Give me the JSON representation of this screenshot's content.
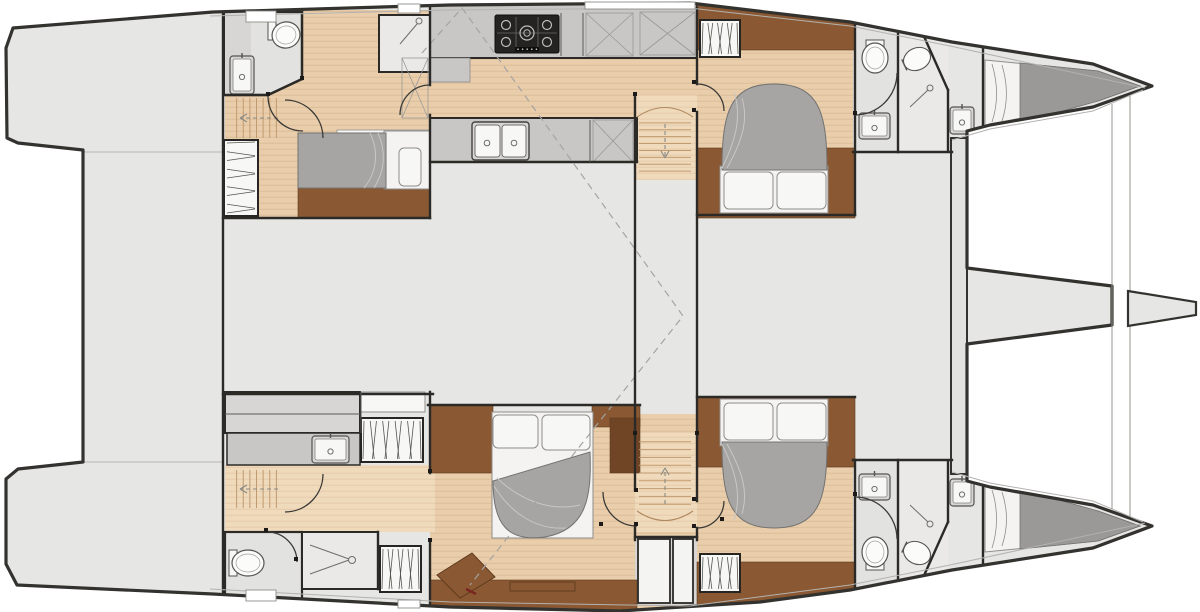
{
  "plan_name": "catamaran-interior-deck-plan",
  "canvas": {
    "width": 1200,
    "height": 612
  },
  "palette": {
    "deck": "#e6e6e4",
    "room": "#e2e2e0",
    "room_light": "#eae9e7",
    "white_box": "#f7f7f5",
    "counter": "#c8c7c5",
    "cabinet": "#d7d6d4",
    "wood": "#eaceac",
    "wood_light": "#f0dabc",
    "wood_stripe": "#d8ba96",
    "wood_stripe_light": "#e2c9a8",
    "tread": "#c19a6f",
    "walnut": "#8a5933",
    "walnut_dark": "#6f4526",
    "walnut_edge": "#5e3a1d",
    "duvet": "#a6a5a3",
    "duvet_edge": "#737270",
    "mattress_gray": "#9a9998",
    "sheet": "#f4f3f1",
    "outline": "#33322e",
    "wall": "#2b2a27",
    "thin": "#8b8a87",
    "inset": "#b3b2af",
    "dash": "#a5a4a1",
    "accent_red": "#7c2420",
    "hatch_border": "#8e8d8a",
    "arc": "#3a3936",
    "stove_body": "#242321",
    "stove_detail": "#bdbdbb"
  },
  "body_path": "M 13,28 L 213,12 L 450,5 L 690,3 L 850,22 L 952,42 L 1093,64 L 1152,86 L 1093,107 L 990,125 L 967,131 L 967,268 L 1112,286 L 1112,325 L 967,344 L 967,481 L 990,487 L 1093,505 L 1152,526 L 1093,548 L 952,570 L 850,590 L 760,602 L 620,611 L 450,607 L 213,594 L 17,585 L 6,564 L 6,479 L 18,469 L 83,462 L 83,150 L 18,143 L 7,138 L 6,48 Z",
  "deck_lines": [
    [
      83,
      152,
      223,
      152
    ],
    [
      83,
      462,
      223,
      462
    ]
  ],
  "inset_lines": [
    [
      [
        210,
        16
      ],
      [
        450,
        10
      ],
      [
        690,
        8
      ],
      [
        850,
        26
      ],
      [
        950,
        46
      ],
      [
        1145,
        88
      ]
    ],
    [
      [
        210,
        589
      ],
      [
        450,
        602
      ],
      [
        690,
        606
      ],
      [
        850,
        585
      ],
      [
        950,
        565
      ],
      [
        1145,
        523
      ]
    ],
    [
      [
        952,
        140
      ],
      [
        990,
        129
      ],
      [
        1093,
        111
      ],
      [
        1143,
        90
      ]
    ],
    [
      [
        952,
        472
      ],
      [
        990,
        483
      ],
      [
        1093,
        501
      ],
      [
        1143,
        522
      ]
    ]
  ],
  "wood_areas": [
    {
      "n": "aft-port-cabin-floor",
      "x": 225,
      "y": 10,
      "w": 205,
      "h": 208,
      "t": "wood"
    },
    {
      "n": "galley-floor",
      "x": 430,
      "y": 58,
      "w": 267,
      "h": 60,
      "t": "wood"
    },
    {
      "n": "port-companionway-floor",
      "x": 635,
      "y": 95,
      "w": 62,
      "h": 85,
      "t": "wood_light"
    },
    {
      "n": "fwd-port-cabin-floor",
      "x": 697,
      "y": 50,
      "w": 158,
      "h": 98,
      "t": "wood"
    },
    {
      "n": "owner-cabin-floor",
      "x": 430,
      "y": 414,
      "w": 267,
      "h": 196,
      "t": "wood"
    },
    {
      "n": "stbd-passage-floor",
      "x": 225,
      "y": 465,
      "w": 210,
      "h": 67,
      "t": "wood_light"
    },
    {
      "n": "stbd-companionway-floor",
      "x": 635,
      "y": 433,
      "w": 62,
      "h": 99,
      "t": "wood_light"
    },
    {
      "n": "fwd-stbd-cabin-floor",
      "x": 697,
      "y": 467,
      "w": 158,
      "h": 95,
      "t": "wood"
    }
  ],
  "rooms": [
    {
      "n": "galley-top-counter",
      "x": 430,
      "y": 4,
      "w": 267,
      "h": 54,
      "f": "counter",
      "s": "wall",
      "sw": 2
    },
    {
      "n": "galley-counter-step",
      "x": 430,
      "y": 58,
      "w": 40,
      "h": 24,
      "f": "counter",
      "s": "thin",
      "sw": 0.8
    },
    {
      "n": "galley-lower-counter",
      "x": 430,
      "y": 118,
      "w": 207,
      "h": 44,
      "f": "counter",
      "s": "wall",
      "sw": 2
    },
    {
      "n": "aft-port-shower",
      "x": 379,
      "y": 15,
      "w": 51,
      "h": 57,
      "f": "room_light",
      "s": "wall",
      "sw": 2
    },
    {
      "n": "fwd-port-head",
      "x": 853,
      "y": 22,
      "w": 45,
      "h": 130,
      "f": "room"
    },
    {
      "n": "fwd-port-shower",
      "x": 898,
      "y": 26,
      "w": 50,
      "h": 126,
      "f": "room_light"
    },
    {
      "n": "stbd-vanity-cabinet",
      "x": 225,
      "y": 392,
      "w": 135,
      "h": 41,
      "f": "cabinet",
      "s": "wall",
      "sw": 2
    },
    {
      "n": "stbd-cabinet-white",
      "x": 361,
      "y": 392,
      "w": 64,
      "h": 20,
      "f": "white_box",
      "s": "hatch_border",
      "sw": 1
    },
    {
      "n": "stbd-vanity-counter",
      "x": 227,
      "y": 433,
      "w": 133,
      "h": 32,
      "f": "counter",
      "s": "wall",
      "sw": 1.5
    },
    {
      "n": "aft-stbd-head",
      "x": 225,
      "y": 532,
      "w": 77,
      "h": 72,
      "f": "room",
      "s": "wall",
      "sw": 2.2
    },
    {
      "n": "aft-stbd-shower",
      "x": 302,
      "y": 532,
      "w": 76,
      "h": 57,
      "f": "room_light",
      "s": "wall",
      "sw": 2
    },
    {
      "n": "fwd-stbd-head",
      "x": 853,
      "y": 460,
      "w": 45,
      "h": 128,
      "f": "room"
    },
    {
      "n": "fwd-stbd-shower",
      "x": 898,
      "y": 460,
      "w": 50,
      "h": 122,
      "f": "room_light"
    },
    {
      "n": "stern-hatch-bay",
      "x": 635,
      "y": 537,
      "w": 62,
      "h": 68,
      "f": "cabinet"
    },
    {
      "n": "bed-shelf",
      "x": 337,
      "y": 130,
      "w": 93,
      "h": 12,
      "f": "white_box",
      "s": "hatch_border",
      "sw": 0.8
    },
    {
      "n": "owner-seat",
      "x": 432,
      "y": 430,
      "w": 40,
      "h": 42,
      "f": "counter",
      "s": "wall",
      "sw": 1.5,
      "rx": 9
    }
  ],
  "head_polygon": {
    "n": "aft-port-head",
    "points": "225,12 302,12 302,79 268,95 225,95",
    "f": "room"
  },
  "head_counter": {
    "n": "aft-port-head-counter",
    "x": 225,
    "y": 12,
    "w": 26,
    "h": 83,
    "f": "cabinet"
  },
  "walnut": [
    {
      "n": "aft-port-bed-base",
      "x": 298,
      "y": 188,
      "w": 132,
      "h": 30
    },
    {
      "n": "fwd-port-band-top",
      "x": 697,
      "y": 5,
      "w": 158,
      "h": 45
    },
    {
      "n": "fwd-port-band-low",
      "x": 697,
      "y": 148,
      "w": 158,
      "h": 70
    },
    {
      "n": "owner-band-left",
      "x": 430,
      "y": 405,
      "w": 63,
      "h": 68
    },
    {
      "n": "owner-band-right",
      "x": 592,
      "y": 405,
      "w": 48,
      "h": 22
    },
    {
      "n": "owner-band-aft",
      "x": 430,
      "y": 580,
      "w": 207,
      "h": 30
    },
    {
      "n": "fwd-stbd-band-top",
      "x": 697,
      "y": 397,
      "w": 158,
      "h": 70
    },
    {
      "n": "fwd-stbd-band-low",
      "x": 697,
      "y": 562,
      "w": 158,
      "h": 43
    }
  ],
  "walnut_dark_blocks": [
    {
      "n": "owner-locker",
      "x": 610,
      "y": 418,
      "w": 30,
      "h": 55
    }
  ],
  "polygons": [
    {
      "n": "owner-desk",
      "points": "437,575 472,553 495,577 460,598",
      "f": "walnut",
      "s": "walnut_edge",
      "sw": 1
    },
    {
      "n": "crew-bow-port-mattress",
      "points": "985,60 1098,71 1140,86 1098,101 985,126",
      "f": "sheet",
      "s": "hatch_border",
      "sw": 1
    },
    {
      "n": "crew-bow-port-duvet",
      "points": "1020,63 1098,71 1140,86 1098,101 1020,123",
      "f": "mattress_gray",
      "s": "duvet_edge",
      "sw": 0.8
    },
    {
      "n": "crew-bow-stbd-mattress",
      "points": "985,486 1098,511 1140,526 1098,541 985,552",
      "f": "sheet",
      "s": "hatch_border",
      "sw": 1
    },
    {
      "n": "crew-bow-stbd-duvet",
      "points": "1020,489 1098,511 1140,526 1098,541 1020,549",
      "f": "mattress_gray",
      "s": "duvet_edge",
      "sw": 0.8
    }
  ],
  "beam": {
    "n": "forward-crossbeam",
    "x": 951,
    "y": 138,
    "w": 16,
    "h": 336
  },
  "bowsprit_tip": {
    "n": "bowsprit",
    "points": "1128,291 1196,302 1196,315 1128,326"
  },
  "tramp_lines": [
    [
      1112,
      104,
      1112,
      509
    ],
    [
      1130,
      96,
      1130,
      517
    ]
  ],
  "beds": [
    {
      "n": "aft-port-bed",
      "sheet": [
        384,
        131,
        46,
        58
      ],
      "pillows": [
        [
          399,
          148,
          22,
          38
        ]
      ],
      "duvet": "M 298,133 L 386,133 L 386,188 L 298,188 Z",
      "folds": [
        "M 370,133 C 379,152 377,172 364,188",
        "M 378,133 C 387,154 384,172 374,188"
      ]
    },
    {
      "n": "fwd-port-bed",
      "sheet": [
        720,
        166,
        108,
        47
      ],
      "pillows": [
        [
          724,
          172,
          49,
          37
        ],
        [
          777,
          172,
          49,
          37
        ]
      ],
      "duvet": "M 722,170 C 722,112 730,84 774,84 C 819,84 827,112 827,170 Z",
      "folds": [
        "M 722,168 C 736,140 742,116 734,92",
        "M 727,168 C 744,138 748,118 742,98"
      ]
    },
    {
      "n": "owner-bed",
      "sheet": [
        492,
        412,
        101,
        126
      ],
      "pillows": [
        [
          493,
          415,
          45,
          33
        ],
        [
          542,
          415,
          48,
          35
        ]
      ],
      "duvet": "M 493,481 L 590,452 C 592,500 585,530 545,537 C 508,542 493,525 493,481 Z",
      "folds": [
        "M 497,478 C 520,500 550,512 580,505",
        "M 494,486 C 512,515 538,530 566,528"
      ]
    },
    {
      "n": "fwd-stbd-bed",
      "sheet": [
        720,
        399,
        108,
        47
      ],
      "pillows": [
        [
          724,
          403,
          49,
          37
        ],
        [
          777,
          403,
          49,
          37
        ]
      ],
      "duvet": "M 722,442 C 722,500 730,528 774,528 C 819,528 827,500 827,442 Z",
      "folds": [
        "M 722,444 C 736,472 742,496 734,520",
        "M 727,444 C 744,474 748,494 742,514"
      ]
    }
  ],
  "wardrobes": [
    {
      "n": "aft-port-wardrobe",
      "x": 224,
      "y": 140,
      "w": 34,
      "h": 76,
      "dir": "h",
      "slats": 9
    },
    {
      "n": "fwd-port-wardrobe",
      "x": 700,
      "y": 20,
      "w": 40,
      "h": 37,
      "dir": "v",
      "slats": 8
    },
    {
      "n": "stbd-counter-wardrobe",
      "x": 361,
      "y": 418,
      "w": 62,
      "h": 44,
      "dir": "v",
      "slats": 10
    },
    {
      "n": "aft-stbd-wardrobe",
      "x": 380,
      "y": 546,
      "w": 41,
      "h": 46,
      "dir": "v",
      "slats": 8
    },
    {
      "n": "fwd-stbd-wardrobe",
      "x": 700,
      "y": 554,
      "w": 40,
      "h": 38,
      "dir": "v",
      "slats": 8
    }
  ],
  "stairs": [
    {
      "n": "aft-port-stairs",
      "x": 230,
      "y": 96,
      "w": 53,
      "h": 44,
      "dir": "v",
      "treads": 7,
      "arrow": [
        278,
        118,
        240,
        118
      ]
    },
    {
      "n": "port-companionway-stairs",
      "x": 637,
      "y": 116,
      "w": 56,
      "h": 62,
      "dir": "h",
      "treads": 8,
      "arrow": [
        665,
        124,
        665,
        158
      ],
      "cap": "M 637,117 Q 665,98 693,117"
    },
    {
      "n": "aft-stbd-stairs",
      "x": 230,
      "y": 468,
      "w": 53,
      "h": 42,
      "dir": "v",
      "treads": 7,
      "arrow": [
        278,
        489,
        240,
        489
      ]
    },
    {
      "n": "stbd-companionway-stairs",
      "x": 637,
      "y": 434,
      "w": 56,
      "h": 78,
      "dir": "h",
      "treads": 9,
      "arrow": [
        665,
        504,
        665,
        468
      ],
      "cap": "M 637,511 Q 665,530 693,511"
    }
  ],
  "stove": {
    "n": "galley-stove",
    "x": 495,
    "y": 15,
    "w": 64,
    "h": 38
  },
  "sinks": [
    {
      "n": "aft-port-head-sink",
      "x": 230,
      "y": 56,
      "w": 24,
      "h": 38
    },
    {
      "n": "fwd-port-head-sink",
      "x": 859,
      "y": 113,
      "w": 31,
      "h": 26
    },
    {
      "n": "stbd-vanity-sink",
      "x": 312,
      "y": 436,
      "w": 37,
      "h": 27
    },
    {
      "n": "fwd-stbd-head-sink",
      "x": 859,
      "y": 474,
      "w": 31,
      "h": 26
    },
    {
      "n": "crew-port-sink",
      "x": 950,
      "y": 107,
      "w": 24,
      "h": 27
    },
    {
      "n": "crew-stbd-sink",
      "x": 950,
      "y": 479,
      "w": 24,
      "h": 27
    }
  ],
  "galley_sink": {
    "n": "galley-double-sink",
    "x": 472,
    "y": 122,
    "w": 57,
    "h": 38
  },
  "toilets": [
    {
      "n": "aft-port-toilet",
      "cx": 286,
      "cy": 35,
      "rx": 14,
      "ry": 13,
      "rot": -15,
      "tank": [
        268,
        22,
        8,
        18
      ]
    },
    {
      "n": "fwd-port-toilet",
      "cx": 875,
      "cy": 58,
      "rx": 13,
      "ry": 15,
      "rot": 0,
      "tank": [
        866,
        40,
        18,
        7
      ]
    },
    {
      "n": "aft-stbd-toilet",
      "cx": 248,
      "cy": 563,
      "rx": 16,
      "ry": 13,
      "rot": 0,
      "tank": [
        229,
        550,
        8,
        26
      ]
    },
    {
      "n": "fwd-stbd-toilet",
      "cx": 875,
      "cy": 552,
      "rx": 13,
      "ry": 15,
      "rot": 0,
      "tank": [
        866,
        563,
        18,
        7
      ]
    }
  ],
  "shower_basins": [
    {
      "n": "fwd-port-shower-basin",
      "cx": 917,
      "cy": 59,
      "rx": 14,
      "ry": 11,
      "rot": -25
    },
    {
      "n": "fwd-stbd-shower-basin",
      "cx": 917,
      "cy": 553,
      "rx": 14,
      "ry": 11,
      "rot": 25
    }
  ],
  "showers": [
    {
      "n": "aft-port-shower-head",
      "lines": [
        [
          400,
          44,
          417,
          24
        ]
      ],
      "c": [
        419,
        21,
        3
      ]
    },
    {
      "n": "fwd-port-shower-head",
      "lines": [
        [
          910,
          107,
          928,
          90
        ]
      ],
      "c": [
        930,
        88,
        3
      ]
    },
    {
      "n": "aft-stbd-shower-head",
      "lines": [
        [
          310,
          545,
          349,
          559
        ],
        [
          310,
          574,
          349,
          560
        ]
      ],
      "c": [
        352,
        560,
        3.5
      ]
    },
    {
      "n": "fwd-stbd-shower-head",
      "lines": [
        [
          910,
          505,
          928,
          522
        ]
      ],
      "c": [
        930,
        524,
        3
      ]
    }
  ],
  "xboxes": [
    [
      586,
      13,
      47,
      43
    ],
    [
      640,
      12,
      55,
      43
    ],
    [
      593,
      120,
      40,
      42
    ],
    [
      402,
      58,
      26,
      60
    ]
  ],
  "stern_hatches": [
    [
      638,
      539,
      32,
      64
    ],
    [
      673,
      539,
      20,
      64
    ]
  ],
  "edge_hatches": [
    [
      246,
      11,
      30,
      11
    ],
    [
      398,
      4,
      22,
      9
    ],
    [
      585,
      2,
      110,
      7
    ],
    [
      246,
      590,
      30,
      11
    ],
    [
      398,
      600,
      22,
      8
    ]
  ],
  "walls": [
    [
      223,
      6,
      223,
      606
    ],
    [
      225,
      95,
      268,
      95
    ],
    [
      268,
      95,
      302,
      79
    ],
    [
      302,
      12,
      302,
      79
    ],
    [
      430,
      8,
      430,
      85
    ],
    [
      430,
      115,
      430,
      218
    ],
    [
      223,
      218,
      430,
      218
    ],
    [
      430,
      162,
      637,
      162
    ],
    [
      635,
      95,
      635,
      490
    ],
    [
      635,
      526,
      635,
      540
    ],
    [
      697,
      8,
      697,
      84
    ],
    [
      697,
      112,
      697,
      501
    ],
    [
      697,
      528,
      697,
      540
    ],
    [
      697,
      215,
      855,
      215
    ],
    [
      855,
      20,
      855,
      215
    ],
    [
      853,
      152,
      952,
      152
    ],
    [
      898,
      30,
      898,
      152
    ],
    [
      922,
      32,
      948,
      90
    ],
    [
      948,
      90,
      948,
      150
    ],
    [
      983,
      45,
      983,
      133
    ],
    [
      223,
      394,
      433,
      394
    ],
    [
      430,
      392,
      430,
      473
    ],
    [
      430,
      542,
      430,
      610
    ],
    [
      428,
      405,
      640,
      405
    ],
    [
      378,
      532,
      378,
      589
    ],
    [
      697,
      397,
      855,
      397
    ],
    [
      855,
      460,
      855,
      604
    ],
    [
      853,
      460,
      952,
      460
    ],
    [
      898,
      460,
      898,
      580
    ],
    [
      922,
      580,
      948,
      522
    ],
    [
      948,
      462,
      948,
      522
    ],
    [
      983,
      479,
      983,
      567
    ],
    [
      635,
      537,
      697,
      537
    ]
  ],
  "thin_walls": [
    [
      561,
      13,
      561,
      56
    ],
    [
      583,
      13,
      583,
      56
    ],
    [
      590,
      120,
      590,
      162
    ],
    [
      361,
      392,
      361,
      433
    ],
    [
      225,
      414,
      360,
      414
    ]
  ],
  "arcs": [
    "M 268,96 A 35 35 0 0 0 303,131",
    "M 430,85 A 30 30 0 0 0 400,115",
    "M 697,84 A 27 27 0 0 1 724,111",
    "M 897,73 A 42 42 0 0 1 855,115",
    "M 267,532 A 30 30 0 0 1 297,562",
    "M 603,492 A 34 34 0 0 0 637,526",
    "M 724,501 A 27 27 0 0 1 697,528",
    "M 855,497 A 42 42 0 0 1 897,539",
    "M 285,100 A 38 38 0 0 1 323,138",
    "M 285,512 A 38 38 0 0 0 323,474"
  ],
  "jambs": [
    [
      694,
      82
    ],
    [
      694,
      110
    ],
    [
      694,
      499
    ],
    [
      694,
      526
    ],
    [
      268,
      94
    ],
    [
      302,
      78
    ],
    [
      601,
      524
    ],
    [
      636,
      490
    ],
    [
      636,
      524
    ],
    [
      722,
      519
    ],
    [
      855,
      113
    ],
    [
      855,
      494
    ],
    [
      266,
      530
    ],
    [
      296,
      559
    ],
    [
      430,
      471
    ],
    [
      430,
      540
    ],
    [
      635,
      94
    ],
    [
      635,
      433
    ],
    [
      697,
      433
    ]
  ],
  "dashed_lines": [
    {
      "n": "hardtop-outline",
      "d": "M 422,53 L 462,8 L 683,316 L 470,585"
    }
  ],
  "accent_marks": [
    {
      "n": "owner-desk-accent",
      "x1": 466,
      "y1": 589,
      "x2": 476,
      "y2": 594
    }
  ],
  "band_inner_rect": {
    "n": "owner-aft-shelf",
    "x": 510,
    "y": 582,
    "w": 65,
    "h": 9
  }
}
